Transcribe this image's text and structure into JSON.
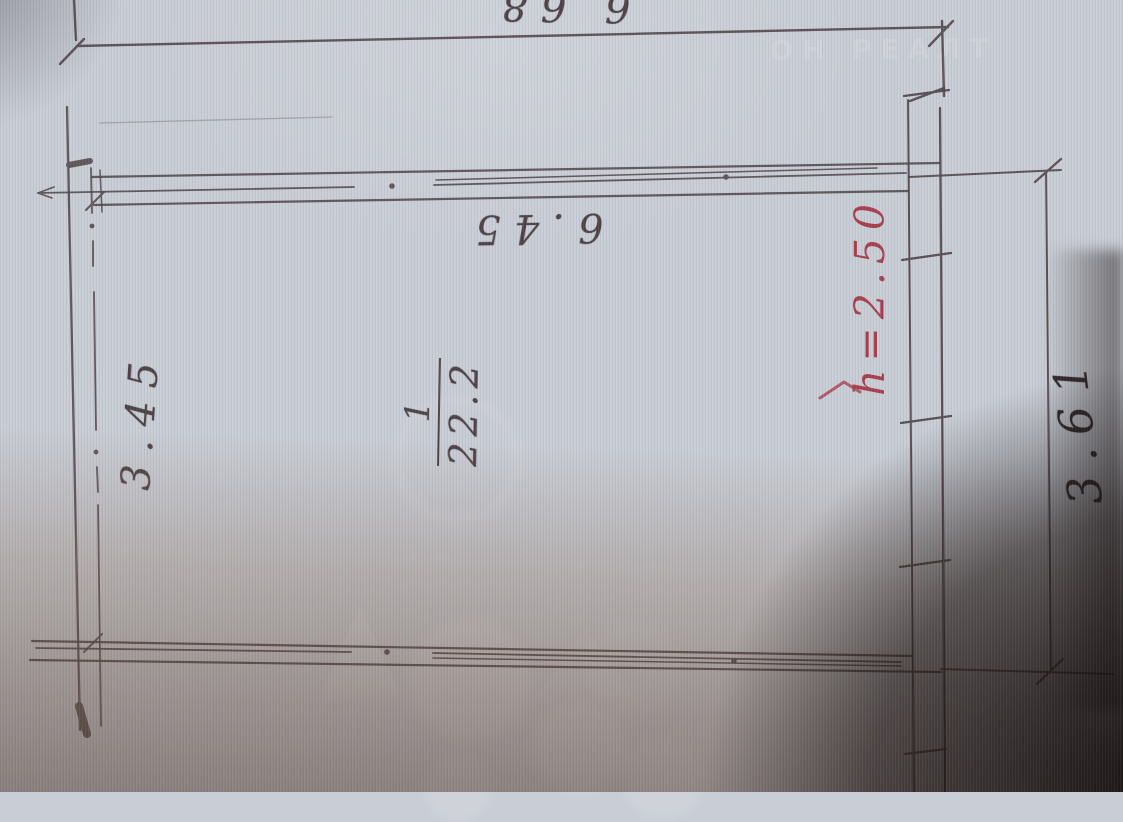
{
  "photo": {
    "watermark_text": "ОН РЕАЛТ"
  },
  "plan": {
    "room": {
      "number": "1",
      "area": "22.2"
    },
    "dimensions": {
      "top_outer": "6.68",
      "top_inner": "6.45",
      "left": "3.45",
      "right": "3.61"
    },
    "annotations": {
      "ceiling_height": "h=2.50"
    }
  },
  "colors": {
    "paper": "#c9cdd5",
    "pencil": "#4e4347",
    "red_annotation": "#a8414f"
  }
}
